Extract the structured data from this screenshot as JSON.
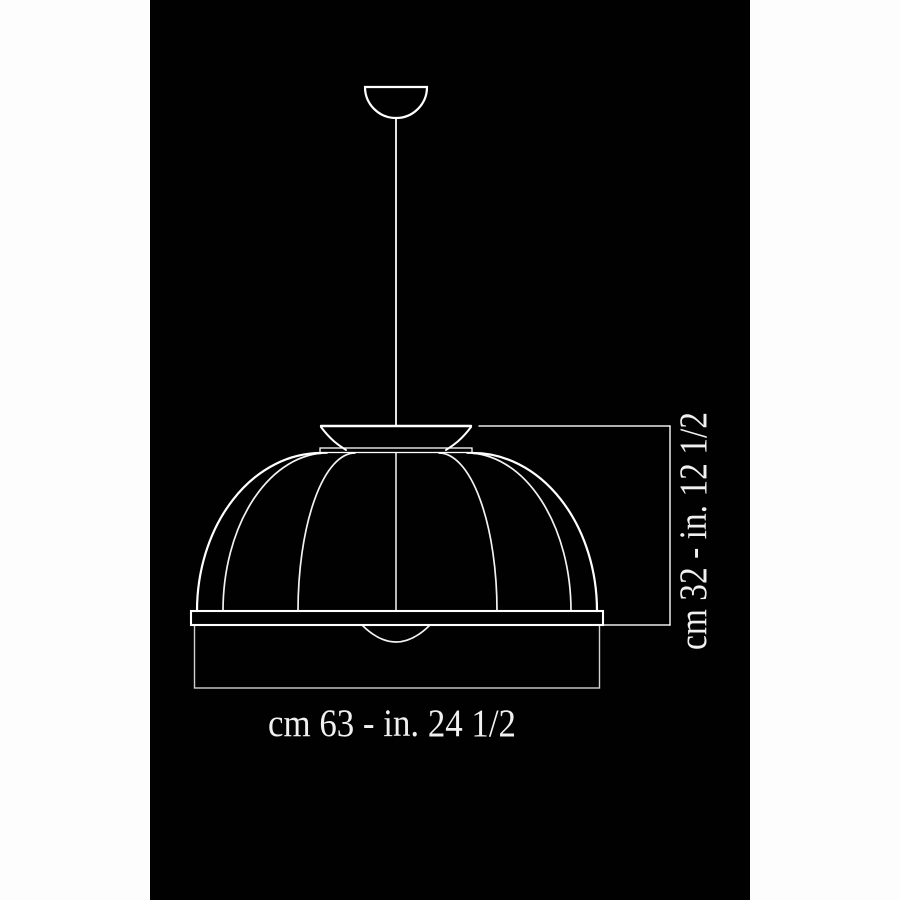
{
  "page": {
    "background_color": "#fdfdfd",
    "panel_color": "#010101",
    "line_color": "#ffffff",
    "text_color": "#f0f0f0"
  },
  "diagram": {
    "subject": "pendant-lamp-dimension-drawing",
    "width_dimension": "cm 63 - in. 24 1/2",
    "height_dimension": "cm 32 - in. 12 1/2"
  }
}
